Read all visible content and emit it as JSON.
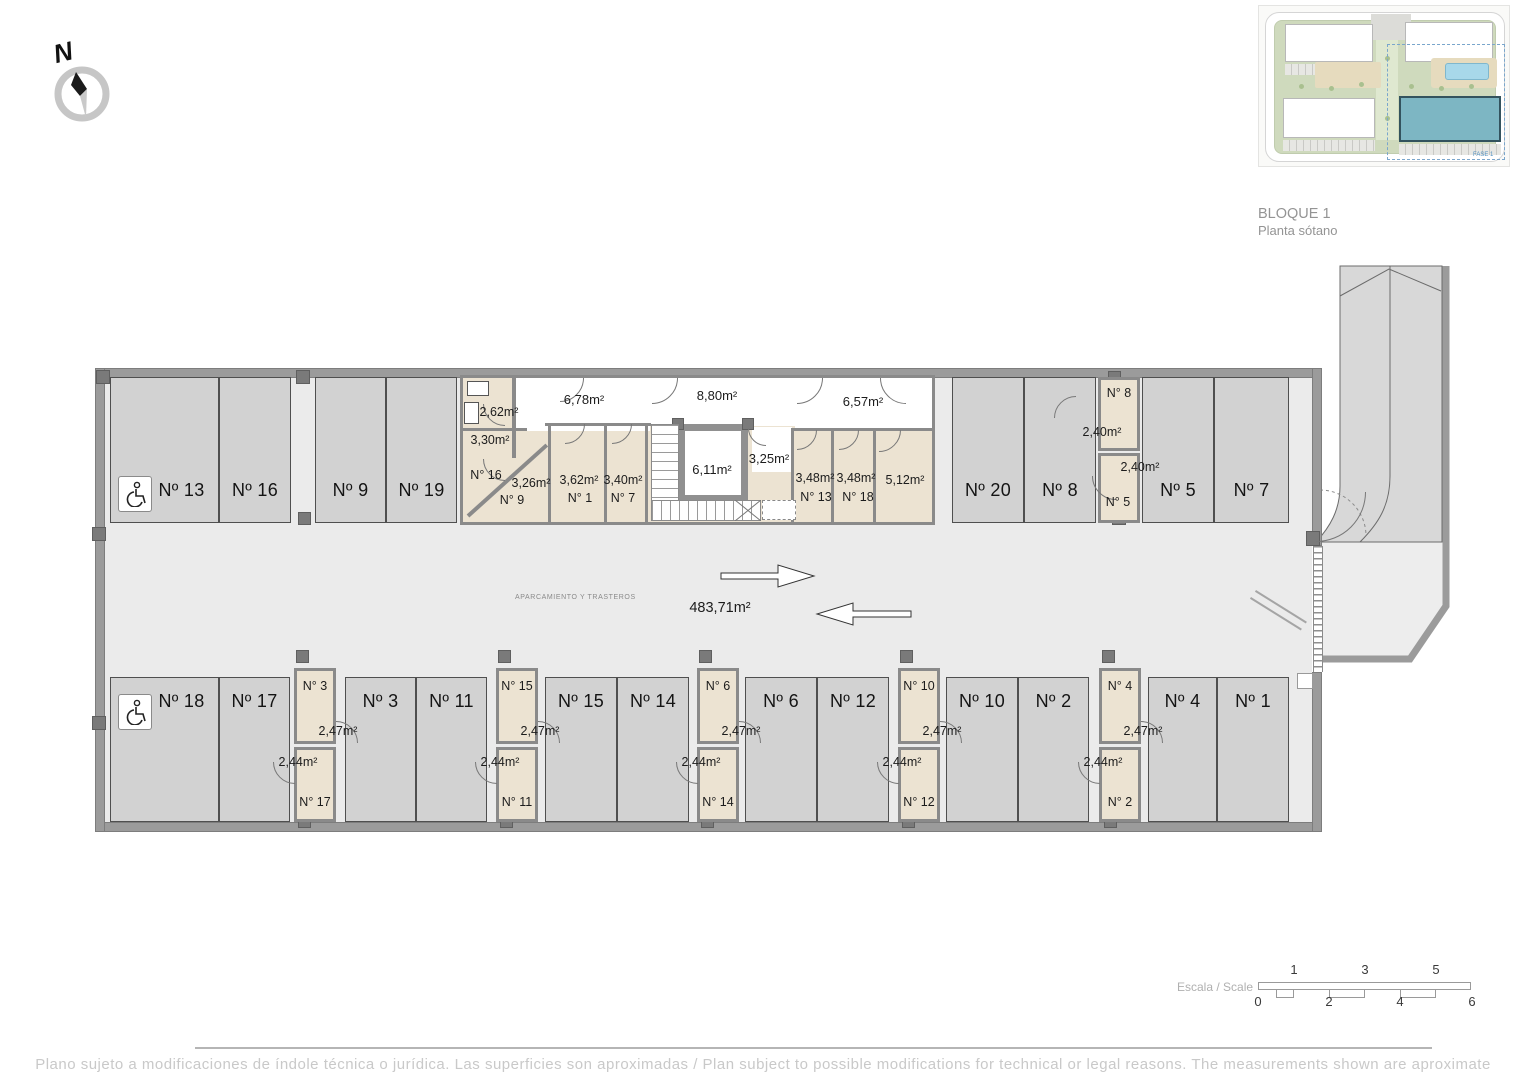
{
  "compass": {
    "north_label": "N"
  },
  "site_plan": {
    "block_title": "BLOQUE 1",
    "floor_title": "Planta sótano",
    "phase_label": "FASE 1"
  },
  "plan": {
    "zone_label": "APARCAMIENTO Y TRASTEROS",
    "total_area": "483,71m²",
    "parking_top": [
      {
        "label": "Nº 13"
      },
      {
        "label": "Nº 16"
      },
      {
        "label": "Nº 9"
      },
      {
        "label": "Nº 19"
      },
      {
        "label": "Nº 20"
      },
      {
        "label": "Nº 8"
      },
      {
        "label": "Nº 5"
      },
      {
        "label": "Nº 7"
      }
    ],
    "parking_bottom": [
      {
        "label": "Nº 18"
      },
      {
        "label": "Nº 17"
      },
      {
        "label": "Nº 3"
      },
      {
        "label": "Nº 11"
      },
      {
        "label": "Nº 15"
      },
      {
        "label": "Nº 14"
      },
      {
        "label": "Nº 6"
      },
      {
        "label": "Nº 12"
      },
      {
        "label": "Nº 10"
      },
      {
        "label": "Nº 2"
      },
      {
        "label": "Nº 4"
      },
      {
        "label": "Nº 1"
      }
    ],
    "corridors": {
      "left": "6,78m²",
      "center": "8,80m²",
      "right": "6,57m²",
      "elevator": "6,11m²",
      "lobby": "3,25m²"
    },
    "storerooms_top": {
      "meter_room_area": "2,62m²",
      "room16_area": "3,30m²",
      "room16_name": "N° 16",
      "room9_area": "3,26m²",
      "room9_name": "N° 9",
      "room1_area": "3,62m²",
      "room1_name": "N° 1",
      "room7_area": "3,40m²",
      "room7_name": "N° 7",
      "room13_area": "3,48m²",
      "room13_name": "N° 13",
      "room18_area": "3,48m²",
      "room18_name": "N° 18",
      "room512_area": "5,12m²",
      "room8_name": "N° 8",
      "room8_area": "2,40m²",
      "room5_name": "N° 5",
      "room5_area": "2,40m²"
    },
    "storeroom_pairs": [
      {
        "top_name": "N° 3",
        "top_area": "2,47m²",
        "bottom_name": "N° 17",
        "bottom_area": "2,44m²"
      },
      {
        "top_name": "N° 15",
        "top_area": "2,47m²",
        "bottom_name": "N° 11",
        "bottom_area": "2,44m²"
      },
      {
        "top_name": "N° 6",
        "top_area": "2,47m²",
        "bottom_name": "N° 14",
        "bottom_area": "2,44m²"
      },
      {
        "top_name": "N° 10",
        "top_area": "2,47m²",
        "bottom_name": "N° 12",
        "bottom_area": "2,44m²"
      },
      {
        "top_name": "N° 4",
        "top_area": "2,47m²",
        "bottom_name": "N° 2",
        "bottom_area": "2,44m²"
      }
    ]
  },
  "icons": {
    "accessible_parking": "wheelchair",
    "north": "compass-needle"
  },
  "scale_bar": {
    "label": "Escala / Scale",
    "top_ticks": [
      "1",
      "3",
      "5"
    ],
    "bottom_ticks": [
      "0",
      "2",
      "4",
      "6"
    ]
  },
  "footer": {
    "disclaimer": "Plano sujeto a modificaciones de índole técnica o jurídica. Las superficies son aproximadas / Plan subject to possible modifications for technical or legal reasons. The measurements  shown are aproximate"
  },
  "colors": {
    "storage_fill": "#ece3d2",
    "parking_fill": "#d2d2d2",
    "wall": "#9b9b9b",
    "floor": "#ebebeb",
    "highlight_building": "#7db6c3",
    "pool": "#a8d8ea"
  }
}
